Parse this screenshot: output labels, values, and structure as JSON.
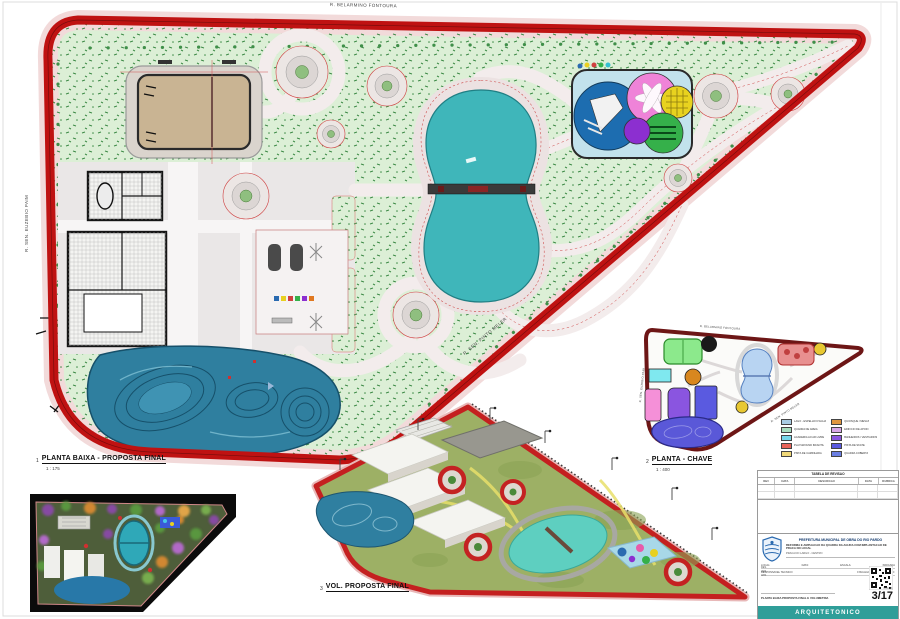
{
  "colors": {
    "road_red": "#bf1212",
    "park_green": "#dcefd6",
    "lake_teal": "#3fb6ba",
    "skatepark_blue": "#2f7f9f",
    "banner_teal": "#2f9e99",
    "sand": "#c9b493",
    "plaza_grey": "#eae7e7"
  },
  "streets": {
    "top": "R. BELARMINO FONTOURA",
    "left": "R. SEN. EUZEBIO PAIM",
    "diagonal": "R. SEN. PINTO MELER"
  },
  "drawings": {
    "plan": {
      "number": "1",
      "title": "PLANTA BAIXA - PROPOSTA FINAL",
      "scale": "1 : 175"
    },
    "key": {
      "number": "2",
      "title": "PLANTA - CHAVE",
      "scale": "1 : 400"
    },
    "vol": {
      "number": "3",
      "title": "VOL. PROPOSTA FINAL",
      "scale": ""
    }
  },
  "key_plan": {
    "legend": [
      {
        "color": "#a9cce3",
        "label": "LAGO - ESPELHO D'AGUA"
      },
      {
        "color": "#a9dfbf",
        "label": "QUADRA DE AREIA"
      },
      {
        "color": "#76d7ea",
        "label": "ACADEMIA AO AR LIVRE"
      },
      {
        "color": "#e8645a",
        "label": "PLAYGROUND INFANTIL"
      },
      {
        "color": "#f0d878",
        "label": "PISTA DE CAMINHADA"
      },
      {
        "color": "#e0973f",
        "label": "QUIOSQUE / MESAS"
      },
      {
        "color": "#d9a7e8",
        "label": "EDIFICIO DE APOIO"
      },
      {
        "color": "#8a55e0",
        "label": "BANHEIROS / VESTIARIOS"
      },
      {
        "color": "#5a5ae0",
        "label": "PISTA DE SKATE"
      },
      {
        "color": "#6b7fe3",
        "label": "QUADRA COBERTA"
      }
    ]
  },
  "title_block": {
    "revision_table": {
      "title": "TABELA DE REVISAO",
      "columns": [
        "REV",
        "DATA",
        "DESCRICAO",
        "DATA",
        "RUBRICA"
      ]
    },
    "org": "PREFEITURA MUNICIPAL DE OBRA DO RIO PARDO",
    "project": "REFORMA E AMPLIACAO DA QUADRA DA AGUDA COM IMPLANTACAO DE PRACA NO LOCAL",
    "address": "PRACA DO LARGO - CENTRO",
    "fields": {
      "local_label": "LOCAL:",
      "data_label": "DATA:",
      "escala_label": "ESCALA:",
      "escala_value": "INDICADA",
      "resp_label": "RESPONSAVEL TECNICO:",
      "fisc_label": "FISCALIZACAO / APROVACAO:",
      "folha_label": "FOLHA:"
    },
    "content": "PLANTA BAIXA PROPOSTA FINAL E VOLUMETRIA",
    "page_number": "3/17",
    "banner": "ARQUITETONICO"
  }
}
